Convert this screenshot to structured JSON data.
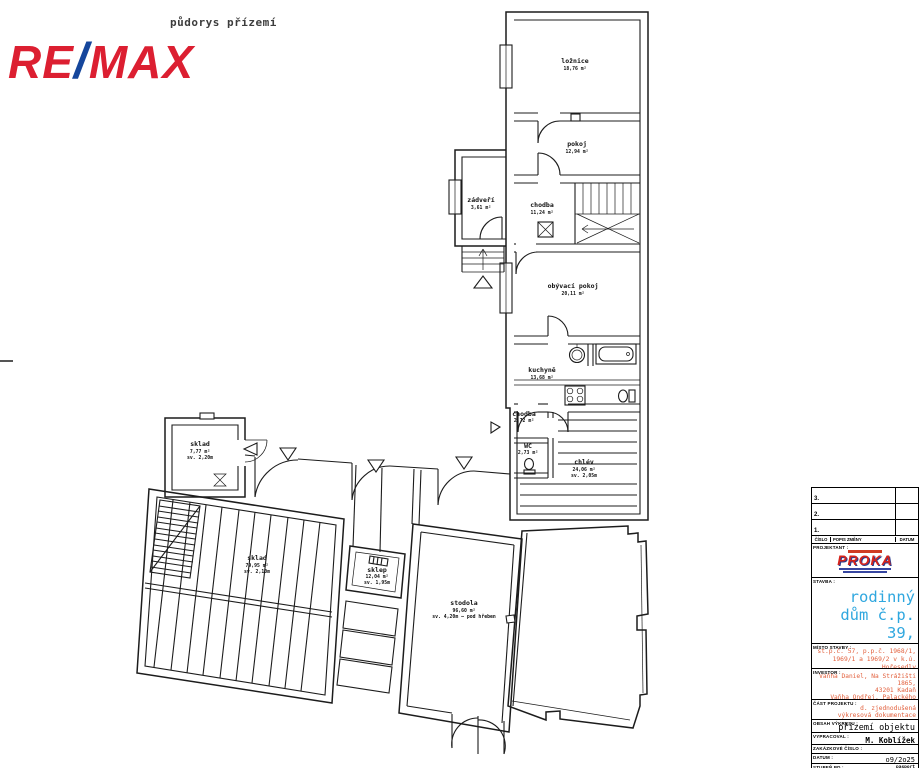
{
  "page": {
    "annotation": "půdorys přízemí"
  },
  "logo": {
    "re": "RE",
    "slash": "/",
    "max": "MAX",
    "red": "#dc1f31",
    "blue": "#15469c"
  },
  "rooms": [
    {
      "name": "ložnice",
      "area": "18,76 m²"
    },
    {
      "name": "pokoj",
      "area": "12,94 m²"
    },
    {
      "name": "chodba",
      "area": "11,24 m²"
    },
    {
      "name": "zádveří",
      "area": "3,61 m²"
    },
    {
      "name": "obývací pokoj",
      "area": "20,11 m²"
    },
    {
      "name": "kuchyně",
      "area": "13,68 m²"
    },
    {
      "name": "chodba",
      "area": "2,72 m²"
    },
    {
      "name": "WC",
      "area": "2,73 m²"
    },
    {
      "name": "chlév",
      "area": "24,06 m²",
      "height": "sv. 2,05m"
    },
    {
      "name": "sklad",
      "area": "7,77 m²",
      "height": "sv. 2,20m"
    },
    {
      "name": "sklad",
      "area": "79,95 m²",
      "height": "sv. 2,10m"
    },
    {
      "name": "sklep",
      "area": "12,04 m²",
      "height": "sv. 1,95m"
    },
    {
      "name": "stodola",
      "area": "96,60 m²",
      "height": "sv. 4,20m – pod hřeben"
    }
  ],
  "title_block": {
    "revisions": [
      {
        "num": "3."
      },
      {
        "num": "2."
      },
      {
        "num": "1."
      }
    ],
    "header": {
      "cislo": "ČÍSLO",
      "popis": "POPIS ZMĚNY",
      "datum": "DATUM"
    },
    "projektant_label": "PROJEKTANT :",
    "proka_name": "PROKA",
    "stavba_label": "STAVBA :",
    "stavba_lines": [
      "rodinný",
      "dům č.p. 39,",
      "Hořesedly"
    ],
    "misto_label": "MÍSTO STAVBY :",
    "misto_lines": [
      "st.p.č. 57, p.p.č. 1968/1,",
      "1969/1 a 1969/2 v k.ú. Hořesedly"
    ],
    "investor_label": "INVESTOR :",
    "investor_lines": [
      "Vaňha Daniel, Na Strážišti 1865,",
      "43201 Kadaň",
      "Vaňha Ondřej, Palackého 3949,",
      "43001 Chomutov"
    ],
    "cast_label": "ČÁST PROJEKTU :",
    "cast_lines": [
      "d. zjednodušená",
      "výkresová dokumentace"
    ],
    "obsah_label": "OBSAH VÝKRESU :",
    "obsah_value": "přízemí objektu",
    "vypracoval_label": "VYPRACOVAL :",
    "vypracoval_value": "M. Koblížek",
    "zakazkove_label": "ZAKÁZKOVÉ ČÍSLO :",
    "datum_label": "DATUM :",
    "datum_value": "o9/2o25",
    "stupen_label": "STUPEŇ PD :",
    "stupen_lines": [
      "pasport",
      "stavby"
    ],
    "format_label": "FORMÁT :"
  },
  "colors": {
    "stavba_blue": "#2fa7df",
    "note_red": "#e2603d",
    "line_black": "#1c1c1c"
  }
}
